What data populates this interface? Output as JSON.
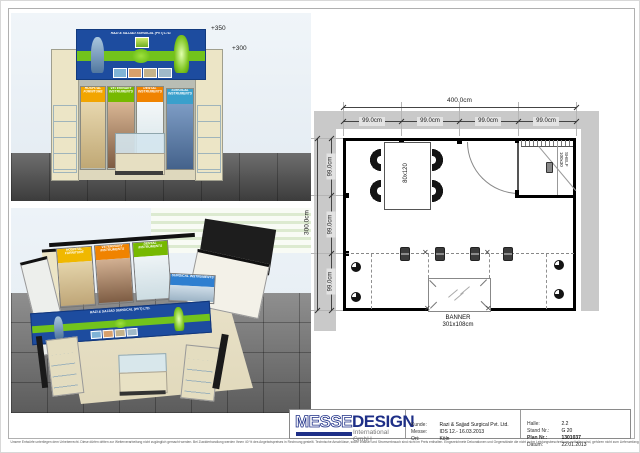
{
  "front_view": {
    "marker_top": "+350",
    "marker_mid": "+300",
    "fascia_title": "RAZI & SAJJAD SURGICAL (PVT) LTD.",
    "banners": [
      {
        "label": "HOSPITAL FURNITURE",
        "color": "#f2a500"
      },
      {
        "label": "VETERINARY INSTRUMENTS",
        "color": "#76b900"
      },
      {
        "label": "DENTAL INSTRUMENTS",
        "color": "#f08300"
      },
      {
        "label": "SURGICAL INSTRUMENTS",
        "color": "#3aa0cc"
      }
    ]
  },
  "iso_view": {
    "fascia_title": "RAZI & SAJJAD SURGICAL (PVT) LTD.",
    "banners": [
      {
        "label": "HOSPITAL FURNITURE",
        "color": "#f0b800"
      },
      {
        "label": "VETERINARY INSTRUMENTS",
        "color": "#f08300"
      },
      {
        "label": "DENTAL INSTRUMENTS",
        "color": "#76b900"
      },
      {
        "label": "SURGICAL INSTRUMENTS",
        "color": "#2f7fd0"
      }
    ]
  },
  "floor_plan": {
    "overall_width": "400.0cm",
    "overall_depth": "300.0cm",
    "top_segments": [
      "99.0cm",
      "99.0cm",
      "99.0cm",
      "99.0cm"
    ],
    "side_segments": [
      "99.0cm",
      "99.0cm",
      "99.0cm"
    ],
    "table_label": "80x120",
    "shelf_line1": "SHELF",
    "shelf_line2": "100x30",
    "banner_label": "BANNER",
    "banner_size": "301x108cm"
  },
  "title_block": {
    "logo_part1": "MESSE",
    "logo_part2": "DESIGN",
    "logo_subtitle": "International GmbH",
    "logo_navy": "#1e2f87",
    "fields_left": [
      {
        "label": "Kunde:",
        "value": "Razi & Sajjad Surgical Pvt. Ltd."
      },
      {
        "label": "Messe:",
        "value": "IDS 12.- 16.03.2013"
      },
      {
        "label": "Ort:",
        "value": "Köln"
      }
    ],
    "fields_right": [
      {
        "label": "Halle:",
        "value": "2.2"
      },
      {
        "label": "Stand Nr.:",
        "value": "G 20"
      },
      {
        "label": "Plan Nr.:",
        "value": "1301037"
      },
      {
        "label": "Datum:",
        "value": "22.01.2013"
      }
    ]
  },
  "colors": {
    "fascia_blue": "#1d4c9f",
    "band_green": "#72c31c"
  },
  "footer": {
    "disclaimer": "Unsere Entwürfe unterliegen dem Urheberrecht. Diese dürfen dritten zur Weiterverarbeitung nicht zugänglich gemacht werden. Bei Zuwiderhandlung werden Ihnen 40 % des Angebotspreises in Rechnung gestellt. Technische Anschlüsse, sowie Wasser und Stromverbrauch sind nicht im Preis enthalten. Eingezeichnete Dekorationen und Gegenstände die nicht in der Leistungsbeschreibung enthalten sind, gehören nicht zum Lieferumfang. Änderungen durch die Messe bleiben vorbehalten."
  }
}
